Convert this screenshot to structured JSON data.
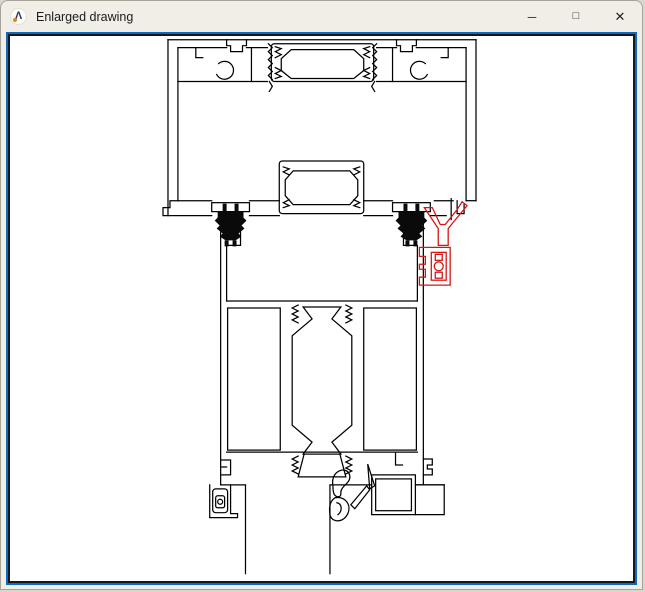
{
  "window": {
    "title": "Enlarged drawing",
    "logo_glyph": "Λ",
    "controls": {
      "minimize": "─",
      "maximize": "□",
      "close": "✕"
    }
  },
  "drawing": {
    "type": "CAD profile cross-section preview",
    "line_color": "#000000",
    "gasket_fill_color": "#0a0a0a",
    "highlight_color": "#d81414",
    "canvas_background": "#ffffff",
    "border_outer_color": "#0e6abc",
    "border_inner_color": "#14181d",
    "parts": {
      "top_profile": "head-frame-extrusion",
      "lower_profile": "sash-extrusion",
      "black_parts": "clip-in-gaskets",
      "red_part": "highlighted-gasket-assembly",
      "bottom_lines": "glass-unit-edges"
    }
  }
}
